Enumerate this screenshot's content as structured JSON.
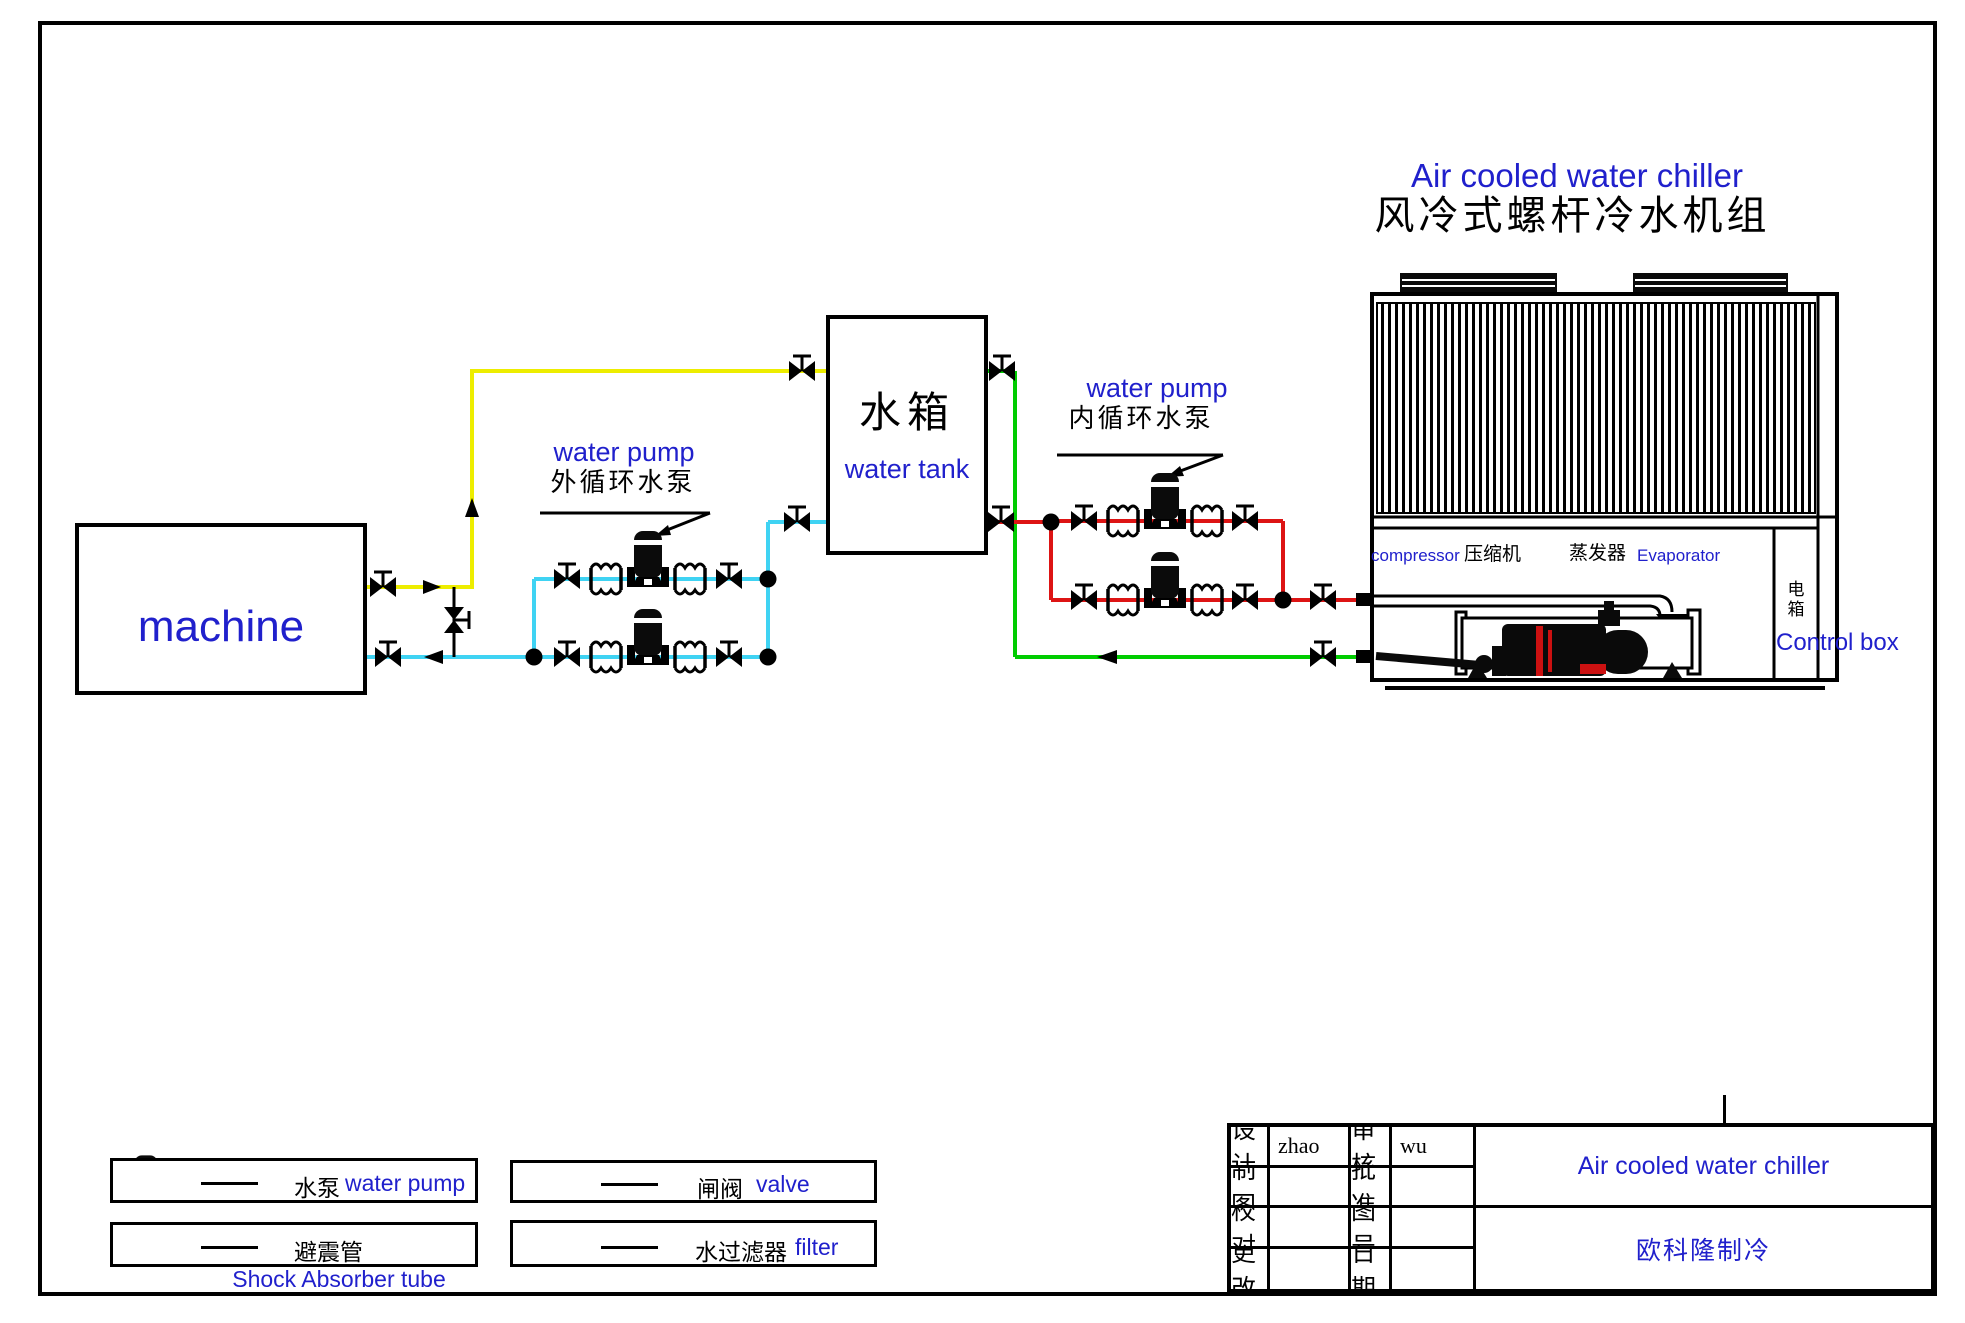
{
  "colors": {
    "accent_blue": "#2020cc",
    "pipe_yellow": "#ededo0",
    "pipe_yellow_hex": "#eded00",
    "pipe_cyan": "#3fd3f3",
    "pipe_green": "#00cc00",
    "pipe_red": "#dd1414"
  },
  "top_title": {
    "en": "Air cooled water chiller",
    "zh": "风冷式螺杆冷水机组"
  },
  "machine": {
    "label": "machine"
  },
  "tank": {
    "zh": "水箱",
    "en": "water tank"
  },
  "pumps": {
    "external": {
      "en": "water pump",
      "zh": "外循环水泵"
    },
    "internal": {
      "en": "water pump",
      "zh": "内循环水泵"
    }
  },
  "chiller": {
    "compressor": {
      "en": "compressor",
      "zh": "压缩机"
    },
    "evaporator": {
      "zh": "蒸发器",
      "en": "Evaporator"
    },
    "control_box": {
      "zh": "电箱",
      "en": "Control box"
    }
  },
  "legend": {
    "water_pump": {
      "zh": "水泵",
      "en": "water pump"
    },
    "shock": {
      "zh": "避震管",
      "en": "Shock Absorber tube"
    },
    "valve": {
      "zh": "闸阀",
      "en": "valve"
    },
    "filter": {
      "zh": "水过滤器",
      "en": "filter"
    }
  },
  "title_block": {
    "design_label": "设计",
    "design_value": "zhao",
    "review_label": "审核",
    "review_value": "wu",
    "draft_label": "制图",
    "approve_label": "批准",
    "check_label": "校对",
    "drawing_no_label": "图号",
    "change_label": "更改",
    "date_label": "日期",
    "title_en": "Air cooled water chiller",
    "company": "欧科隆制冷"
  }
}
